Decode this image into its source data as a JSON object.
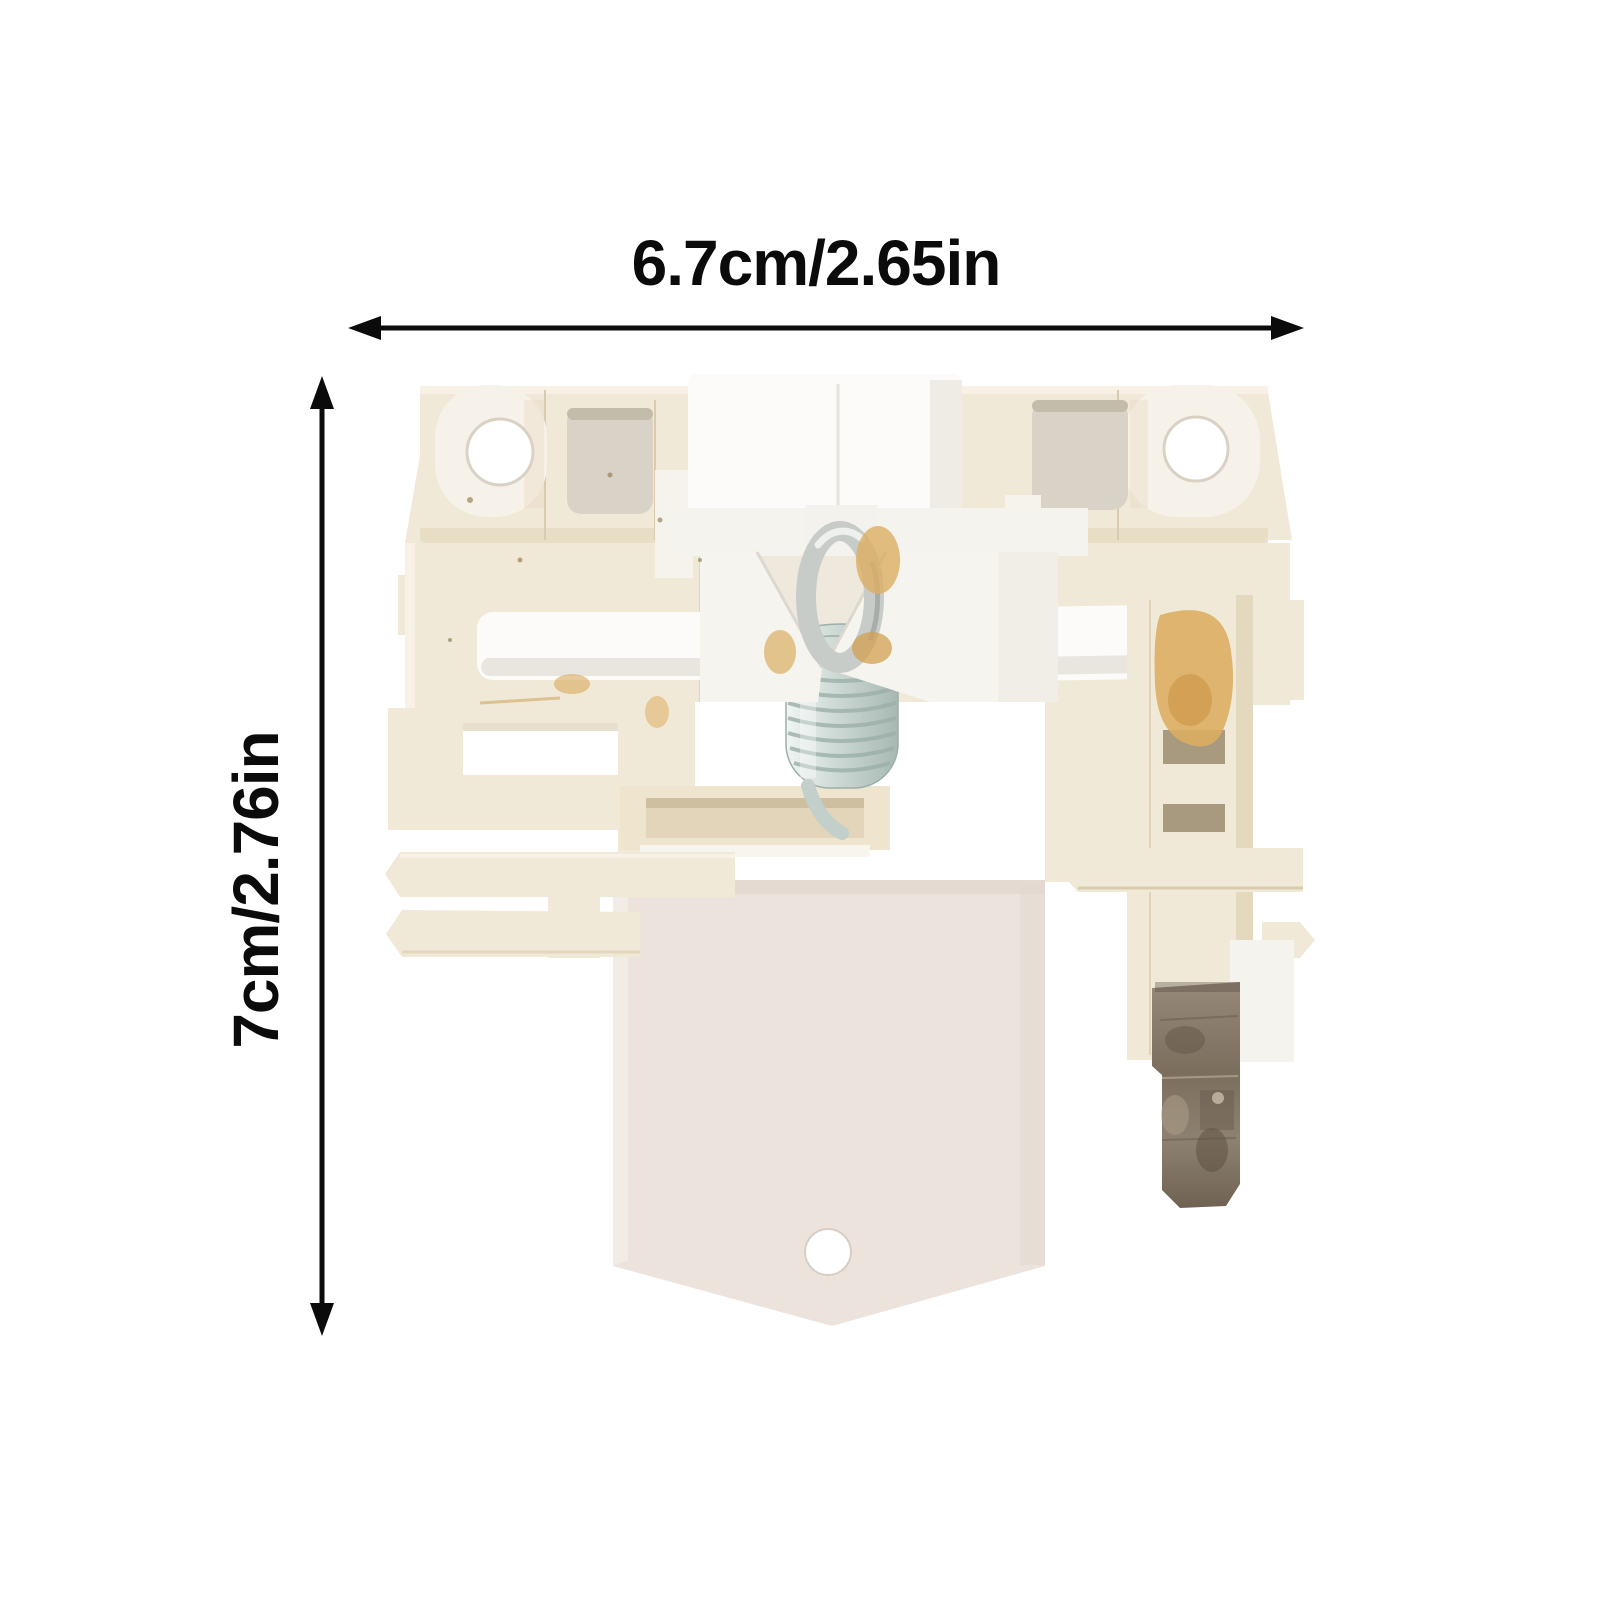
{
  "annotations": {
    "width_label": "6.7cm/2.65in",
    "height_label": "7cm/2.76in"
  },
  "product": {
    "kind": "dishwasher door lock latch assembly photo",
    "features": [
      "mounting ear with hole left",
      "mounting ear with hole right",
      "metal hook and coil spring center",
      "bottom pointed plate with hole",
      "metal terminal blade lower right",
      "grease spots",
      "white guide pins"
    ]
  },
  "colors": {
    "bg": "#ffffff",
    "ink": "#0b0b0b",
    "cream": "#f1e9d7",
    "cream_shade": "#e4d8bf",
    "cream_dark": "#d9cbae",
    "cream_light": "#f8f2e6",
    "white_plastic": "#fcfbf9",
    "bracket_white": "#f5f3ee",
    "pocket": "#d9d3c7",
    "plate": "#ece3dc",
    "spring": "#cdd9d4",
    "spring_dark": "#9bafa9",
    "hook": "#c8ccc9",
    "grease": "#dcae63",
    "metal": "#8d8071",
    "slot": "#a79a7e"
  }
}
